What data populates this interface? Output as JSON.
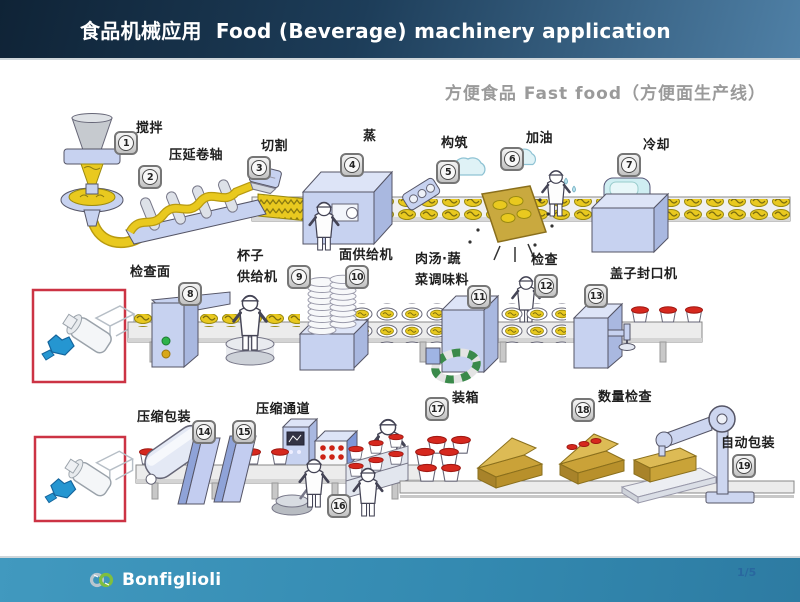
{
  "header": {
    "title_zh": "食品机械应用",
    "title_en": "Food (Beverage) machinery application"
  },
  "subtitle": "方便食品 Fast food（方便面生产线）",
  "steps": [
    {
      "num": "1",
      "label": "搅拌"
    },
    {
      "num": "2",
      "label": "压延卷轴"
    },
    {
      "num": "3",
      "label": "切割"
    },
    {
      "num": "4",
      "label": "蒸"
    },
    {
      "num": "5",
      "label": "构筑"
    },
    {
      "num": "6",
      "label": "加油"
    },
    {
      "num": "7",
      "label": "冷却"
    },
    {
      "num": "8",
      "label": "检查面"
    },
    {
      "num": "9",
      "label": "杯子\n供给机"
    },
    {
      "num": "10",
      "label": "面供给机"
    },
    {
      "num": "11",
      "label": "肉汤·蔬\n菜调味料"
    },
    {
      "num": "12",
      "label": "检查"
    },
    {
      "num": "13",
      "label": "盖子封口机"
    },
    {
      "num": "14",
      "label": "压缩包装"
    },
    {
      "num": "15",
      "label": "压缩通道"
    },
    {
      "num": "16",
      "label": ""
    },
    {
      "num": "17",
      "label": "装箱"
    },
    {
      "num": "18",
      "label": "数量检查"
    },
    {
      "num": "19",
      "label": "自动包装"
    }
  ],
  "footer": {
    "brand": "Bonfiglioli",
    "page": "1/5"
  },
  "icons": [
    "bonfiglioli-logo-icon",
    "gearmotor-inset-icon"
  ],
  "colors": {
    "header_start": "#0f2336",
    "header_end": "#4f80a6",
    "footer_teal": "#3f96bc",
    "subtitle_gray": "#9a9a9a",
    "machine_blue": "#c7d2f0",
    "machine_blue_dark": "#a9b8e0",
    "noodle_yellow": "#e9c91f",
    "lid_red": "#d6281e",
    "inset_border_red": "#cc3344",
    "badge_gray": "#767676",
    "logo_green": "#7fbf3f",
    "page_num_blue": "#29679f"
  }
}
